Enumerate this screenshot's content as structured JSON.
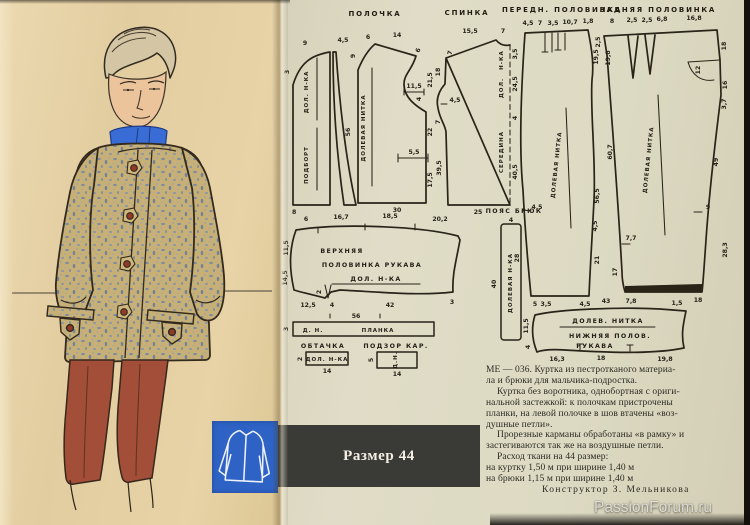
{
  "colors": {
    "paper_left": "#e2cda0",
    "paper_right": "#dddac3",
    "accent_blue": "#2e63c5",
    "badge_bar": "#3a3a37",
    "jacket_tan": "#c6b077",
    "speckle_blue": "#6f86a8",
    "pants_rust": "#a24e38",
    "scarf_blue": "#3a6cd6",
    "ink": "#292318"
  },
  "headers": {
    "polochka": "ПОЛОЧКА",
    "spinka": "СПИНКА",
    "peredn": "ПЕРЕДН. ПОЛОВИНКА",
    "zadn": "ЗАДНЯЯ ПОЛОВИНКА"
  },
  "podbort": {
    "name": "ПОДБОРТ",
    "grain": "ДОЛ. Н-КА",
    "t1": "9",
    "t2": "4,5",
    "l1": "3",
    "b1": "8",
    "e1": "56"
  },
  "polochka": {
    "grain": "ДОЛЕВАЯ НИТКА",
    "t1": "6",
    "t2": "14",
    "s1": "6",
    "l1": "9",
    "r1": "21,5",
    "a1": "11,5",
    "a2": "4",
    "r2": "22",
    "p1": "5,5",
    "r3": "17,5",
    "b1": "30"
  },
  "spinka": {
    "mid": "СЕРЕДИНА",
    "g1": "ДОЛ.",
    "g2": "Н-КА",
    "t1": "15,5",
    "t2": "7",
    "l1": "7",
    "l2": "18",
    "l3": "4,5",
    "l4": "7",
    "l5": "39,5",
    "r1": "3,5",
    "r2": "24,5",
    "r3": "4",
    "r4": "40,5",
    "b1": "25"
  },
  "ftrous": {
    "grain": "ДОЛЕВАЯ НИТКА",
    "t1": "4,5",
    "t2": "7",
    "t3": "3,5",
    "t4": "10,7",
    "t5": "1,8",
    "r1": "19,5",
    "r2": "56,5",
    "r3": "4,5",
    "r4": "21",
    "l1": "4,5",
    "l2": "28",
    "b1": "5",
    "b2": "4,5"
  },
  "btrous": {
    "grain": "ДОЛЕВАЯ НИТКА",
    "t1": "8",
    "t2": "2,5",
    "t3": "2,5",
    "t4": "6,8",
    "t5": "16,8",
    "l0": "2,5",
    "l1": "19,8",
    "l2": "60,7",
    "l3": "7,7",
    "l4": "17",
    "b1": "7,8",
    "b2": "18",
    "r1": "18",
    "r2": "12",
    "r3": "16",
    "r4": "3,7",
    "r5": "49",
    "r6": "9",
    "r7": "28,3"
  },
  "belt": {
    "label": "ПОЯС БРЮК",
    "grain": "ДОЛЕВАЯ Н-КА",
    "t1": "4",
    "l1": "40"
  },
  "usleeve": {
    "n1": "ВЕРХНЯЯ",
    "n2": "ПОЛОВИНКА РУКАВА",
    "grain": "ДОЛ. Н-КА",
    "t1": "6",
    "t2": "16,7",
    "t3": "18,5",
    "t4": "20,2",
    "l1": "11,5",
    "l2": "14,5",
    "b1": "12,5",
    "b2": "4",
    "b3": "42",
    "b4": "3",
    "d1": "2"
  },
  "planka": {
    "g": "Д. Н.",
    "name": "ПЛАНКА",
    "t1": "56",
    "l1": "3"
  },
  "obtachka": {
    "label": "ОБТАЧКА",
    "g": "ДОЛ. Н-КА",
    "l1": "2",
    "b1": "14"
  },
  "podzor": {
    "label": "ПОДЗОР КАР.",
    "g": "Д.Н.",
    "l1": "5",
    "b1": "14"
  },
  "lsleeve": {
    "g": "ДОЛЕВ. НИТКА",
    "n1": "НИЖНЯЯ ПОЛОВ.",
    "n2": "РУКАВА",
    "t1": "3,5",
    "t2": "43",
    "t3": "1,5",
    "l1": "11,5",
    "l2": "4",
    "b1": "16,3",
    "b2": "18",
    "b3": "19,8"
  },
  "desc": {
    "l1": "МЕ — 036. Куртка из пестротканого материа-",
    "l2": "ла и брюки для мальчика-подростка.",
    "l3": "Куртка без воротника, однобортная с ориги-",
    "l4": "нальной застежкой: к полочкам пристрочены",
    "l5": "планки, на левой полочке в шов втачены «воз-",
    "l6": "душные петли».",
    "l7": "Прорезные карманы обработаны «в рамку» и",
    "l8": "застегиваются так же на воздушные петли.",
    "l9": "Расход ткани на 44 размер:",
    "l10": "на куртку 1,50 м при ширине 1,40 м",
    "l11": "на брюки 1,15 м при ширине 1,40 м",
    "l12": "Конструктор З. Мельникова"
  },
  "badge": {
    "size": "Размер 44"
  },
  "watermark": "PassionForum.ru"
}
